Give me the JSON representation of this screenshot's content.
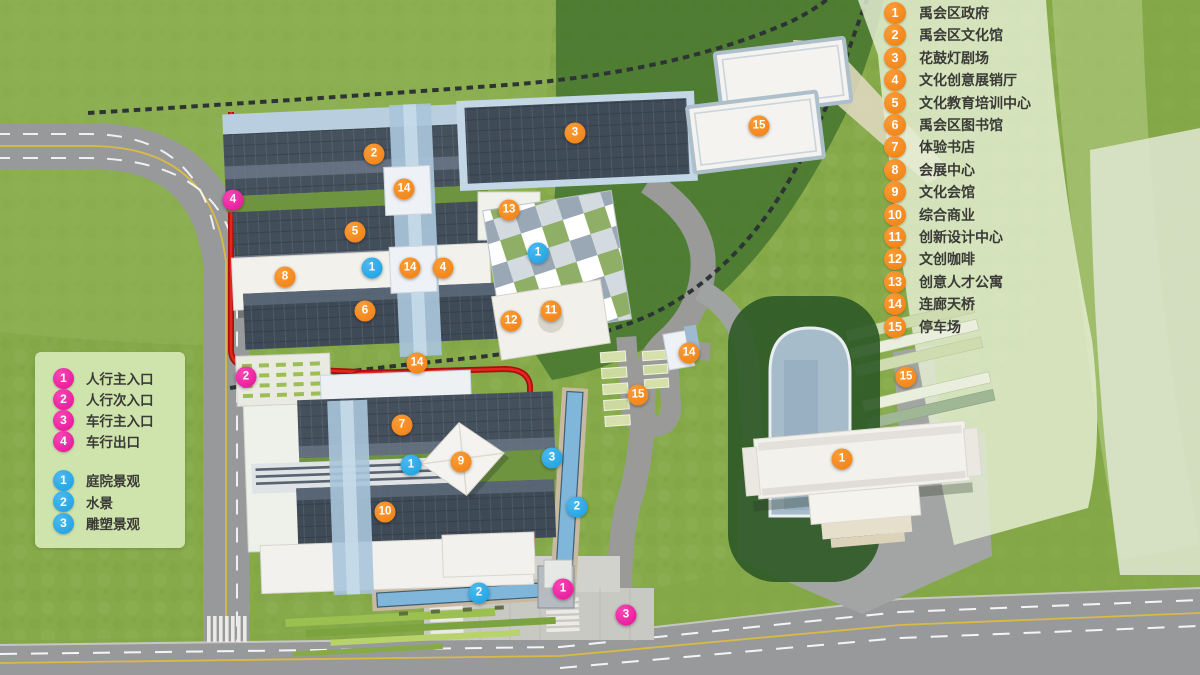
{
  "colors": {
    "marker_building": "#f0800f",
    "marker_entrance": "#e60f97",
    "marker_landscape": "#189fe0",
    "grass": "#86aa4a",
    "road": "#98999a",
    "route_line": "#c01212",
    "water": "#7fb6da",
    "roof_dark": "#434e5b",
    "building_white": "#f2f1ec"
  },
  "legend_right": {
    "items": [
      {
        "num": "1",
        "label": "禹会区政府"
      },
      {
        "num": "2",
        "label": "禹会区文化馆"
      },
      {
        "num": "3",
        "label": "花鼓灯剧场"
      },
      {
        "num": "4",
        "label": "文化创意展销厅"
      },
      {
        "num": "5",
        "label": "文化教育培训中心"
      },
      {
        "num": "6",
        "label": "禹会区图书馆"
      },
      {
        "num": "7",
        "label": "体验书店"
      },
      {
        "num": "8",
        "label": "会展中心"
      },
      {
        "num": "9",
        "label": "文化会馆"
      },
      {
        "num": "10",
        "label": "综合商业"
      },
      {
        "num": "11",
        "label": "创新设计中心"
      },
      {
        "num": "12",
        "label": "文创咖啡"
      },
      {
        "num": "13",
        "label": "创意人才公寓"
      },
      {
        "num": "14",
        "label": "连廊天桥"
      },
      {
        "num": "15",
        "label": "停车场"
      }
    ]
  },
  "legend_left": {
    "entrance_items": [
      {
        "num": "1",
        "label": "人行主入口"
      },
      {
        "num": "2",
        "label": "人行次入口"
      },
      {
        "num": "3",
        "label": "车行主入口"
      },
      {
        "num": "4",
        "label": "车行出口"
      }
    ],
    "landscape_items": [
      {
        "num": "1",
        "label": "庭院景观"
      },
      {
        "num": "2",
        "label": "水景"
      },
      {
        "num": "3",
        "label": "雕塑景观"
      }
    ]
  },
  "map_markers": {
    "building": [
      {
        "num": "2",
        "x": 374,
        "y": 154
      },
      {
        "num": "3",
        "x": 575,
        "y": 133
      },
      {
        "num": "15",
        "x": 759,
        "y": 126
      },
      {
        "num": "14",
        "x": 404,
        "y": 189
      },
      {
        "num": "13",
        "x": 509,
        "y": 210
      },
      {
        "num": "5",
        "x": 355,
        "y": 232
      },
      {
        "num": "14",
        "x": 410,
        "y": 268
      },
      {
        "num": "4",
        "x": 443,
        "y": 268
      },
      {
        "num": "8",
        "x": 285,
        "y": 277
      },
      {
        "num": "6",
        "x": 365,
        "y": 311
      },
      {
        "num": "11",
        "x": 551,
        "y": 311
      },
      {
        "num": "12",
        "x": 511,
        "y": 321
      },
      {
        "num": "14",
        "x": 417,
        "y": 363
      },
      {
        "num": "14",
        "x": 689,
        "y": 353
      },
      {
        "num": "15",
        "x": 638,
        "y": 395
      },
      {
        "num": "7",
        "x": 402,
        "y": 425
      },
      {
        "num": "9",
        "x": 461,
        "y": 462
      },
      {
        "num": "10",
        "x": 385,
        "y": 512
      },
      {
        "num": "15",
        "x": 906,
        "y": 377
      },
      {
        "num": "1",
        "x": 842,
        "y": 459
      }
    ],
    "entrance": [
      {
        "num": "4",
        "x": 233,
        "y": 200
      },
      {
        "num": "2",
        "x": 246,
        "y": 377
      },
      {
        "num": "1",
        "x": 563,
        "y": 589
      },
      {
        "num": "3",
        "x": 626,
        "y": 615
      }
    ],
    "landscape": [
      {
        "num": "1",
        "x": 372,
        "y": 268
      },
      {
        "num": "1",
        "x": 538,
        "y": 253
      },
      {
        "num": "1",
        "x": 411,
        "y": 465
      },
      {
        "num": "3",
        "x": 552,
        "y": 458
      },
      {
        "num": "2",
        "x": 577,
        "y": 507
      },
      {
        "num": "2",
        "x": 479,
        "y": 593
      }
    ]
  }
}
